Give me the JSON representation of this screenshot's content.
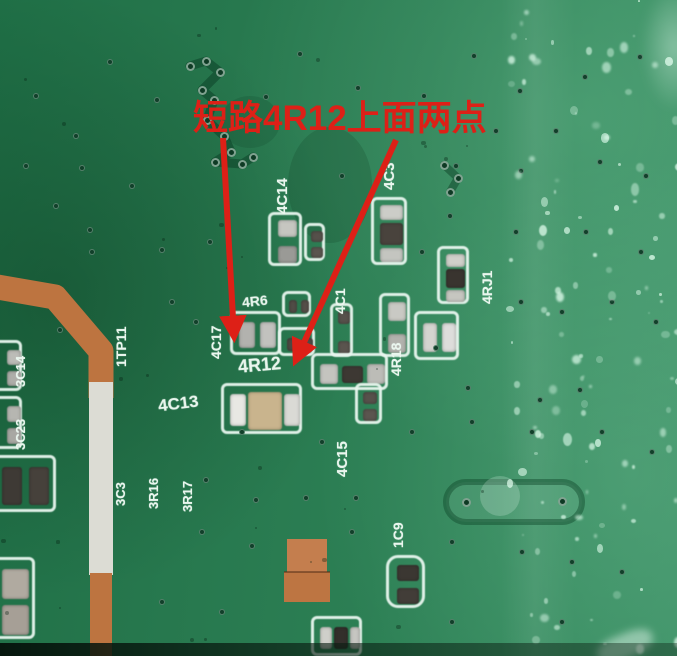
{
  "annotation": {
    "text": "短路4R12上面两点",
    "color": "#dd2017"
  },
  "board": {
    "base_color": "#2a7a50",
    "copper_color": "#bd7440",
    "silkscreen_color": "#e8f4ec",
    "white_strip_color": "#dcdcd4"
  },
  "labels": [
    {
      "id": "4C14",
      "text": "4C14"
    },
    {
      "id": "4C3",
      "text": "4C3"
    },
    {
      "id": "4RJ1",
      "text": "4RJ1"
    },
    {
      "id": "4R6",
      "text": "4R6"
    },
    {
      "id": "4C17",
      "text": "4C17"
    },
    {
      "id": "4R12",
      "text": "4R12"
    },
    {
      "id": "4C1",
      "text": "4C1"
    },
    {
      "id": "4R18",
      "text": "4R18"
    },
    {
      "id": "4C13",
      "text": "4C13"
    },
    {
      "id": "4C15",
      "text": "4C15"
    },
    {
      "id": "1C9",
      "text": "1C9"
    },
    {
      "id": "1TP11",
      "text": "1TP11"
    },
    {
      "id": "3C14",
      "text": "3C14"
    },
    {
      "id": "3C23",
      "text": "3C23"
    },
    {
      "id": "3C3",
      "text": "3C3"
    },
    {
      "id": "3R16",
      "text": "3R16"
    },
    {
      "id": "3R17",
      "text": "3R17"
    }
  ],
  "vias": [
    [
      110,
      62
    ],
    [
      157,
      100
    ],
    [
      266,
      97
    ],
    [
      358,
      88
    ],
    [
      300,
      54
    ],
    [
      424,
      96
    ],
    [
      474,
      56
    ],
    [
      520,
      91
    ],
    [
      585,
      77
    ],
    [
      640,
      57
    ],
    [
      82,
      168
    ],
    [
      132,
      186
    ],
    [
      56,
      206
    ],
    [
      342,
      176
    ],
    [
      456,
      166
    ],
    [
      521,
      171
    ],
    [
      600,
      162
    ],
    [
      646,
      176
    ],
    [
      92,
      252
    ],
    [
      162,
      250
    ],
    [
      210,
      242
    ],
    [
      450,
      216
    ],
    [
      516,
      232
    ],
    [
      586,
      232
    ],
    [
      641,
      252
    ],
    [
      172,
      302
    ],
    [
      196,
      322
    ],
    [
      422,
      252
    ],
    [
      521,
      302
    ],
    [
      562,
      312
    ],
    [
      612,
      302
    ],
    [
      656,
      322
    ],
    [
      242,
      432
    ],
    [
      322,
      442
    ],
    [
      412,
      432
    ],
    [
      472,
      422
    ],
    [
      532,
      432
    ],
    [
      602,
      432
    ],
    [
      652,
      452
    ],
    [
      202,
      532
    ],
    [
      252,
      546
    ],
    [
      352,
      532
    ],
    [
      452,
      542
    ],
    [
      522,
      552
    ],
    [
      572,
      562
    ],
    [
      622,
      572
    ],
    [
      162,
      602
    ],
    [
      222,
      612
    ],
    [
      452,
      622
    ],
    [
      562,
      622
    ],
    [
      76,
      136
    ],
    [
      36,
      96
    ],
    [
      26,
      166
    ],
    [
      496,
      131
    ],
    [
      556,
      131
    ],
    [
      306,
      498
    ],
    [
      256,
      500
    ],
    [
      206,
      480
    ],
    [
      356,
      498
    ],
    [
      436,
      348
    ],
    [
      468,
      388
    ],
    [
      540,
      400
    ],
    [
      580,
      390
    ],
    [
      90,
      230
    ],
    [
      60,
      330
    ]
  ],
  "via_cluster_top": [
    [
      190,
      66
    ],
    [
      206,
      61
    ],
    [
      220,
      72
    ],
    [
      202,
      90
    ],
    [
      214,
      100
    ],
    [
      207,
      120
    ],
    [
      224,
      136
    ],
    [
      231,
      152
    ],
    [
      215,
      162
    ],
    [
      242,
      164
    ],
    [
      253,
      157
    ]
  ],
  "via_cluster_mid": [
    [
      444,
      165
    ],
    [
      458,
      178
    ],
    [
      450,
      192
    ]
  ],
  "dogbone_vias": [
    [
      466,
      502
    ],
    [
      562,
      501
    ]
  ]
}
